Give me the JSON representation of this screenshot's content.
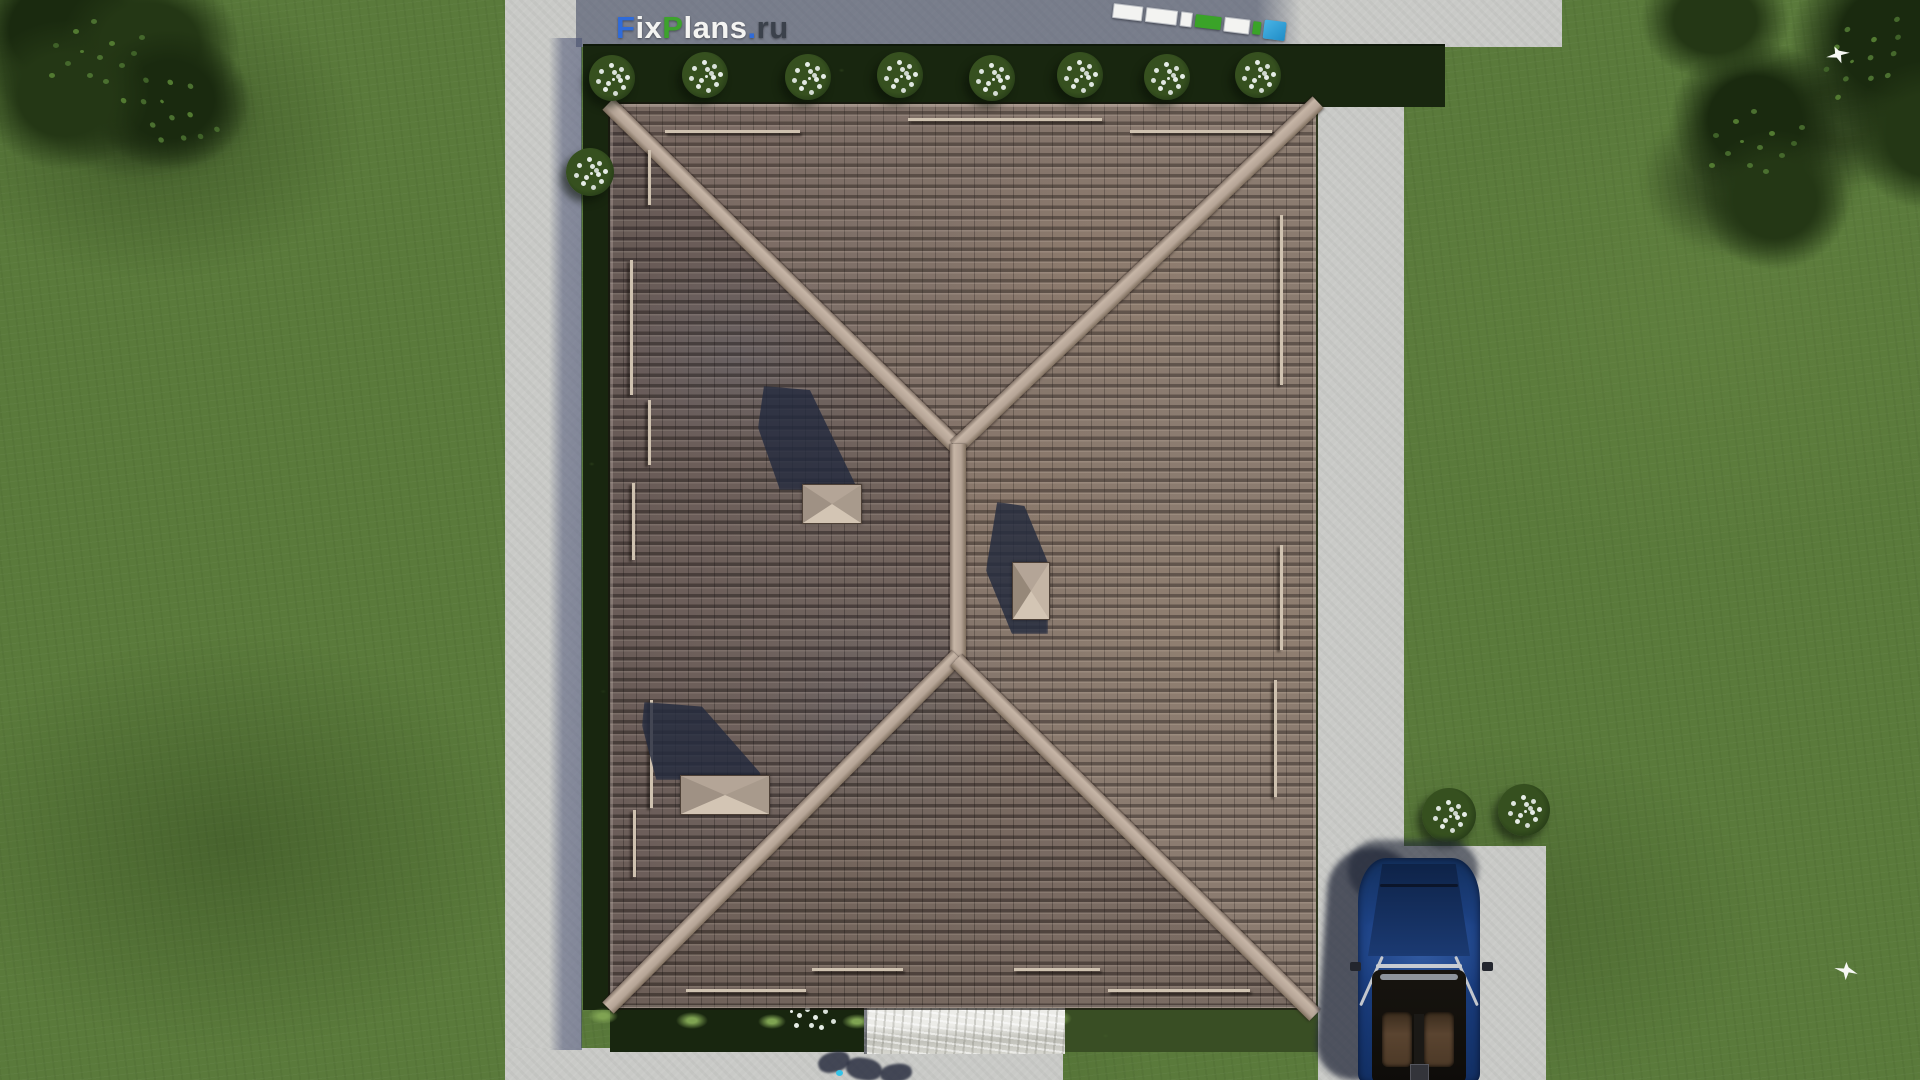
{
  "watermark": {
    "full_text": "FixPlans.ru",
    "segments": [
      {
        "text": "F",
        "style": "color:#2f6bd9"
      },
      {
        "text": "ix",
        "style": "color:#f4f4f2"
      },
      {
        "text": "P",
        "style": "color:#3da32c"
      },
      {
        "text": "lans",
        "style": "color:#f4f4f2"
      },
      {
        "text": ".",
        "style": "color:#2f6bd9"
      },
      {
        "text": "ru",
        "style": "color:#3b414b"
      }
    ]
  },
  "palette": {
    "lawn": "#5a7a3b",
    "pavement": "#c9cac7",
    "pavement-shadow": "#5f6782",
    "hedge": "#18260f",
    "roof-base": "#7b6b62",
    "roof-ridge": "#b9a898",
    "chimney": "#bcad9e",
    "shadow": "#242b3f",
    "car-body": "#1c4084",
    "walkway": "#dcdcd5",
    "ruler-white": "#f3f3f1",
    "ruler-green": "#3aa328",
    "ruler-blue": "#2f9fd9",
    "flowers": "#e6ede7",
    "bird": "#f6f8f4"
  }
}
